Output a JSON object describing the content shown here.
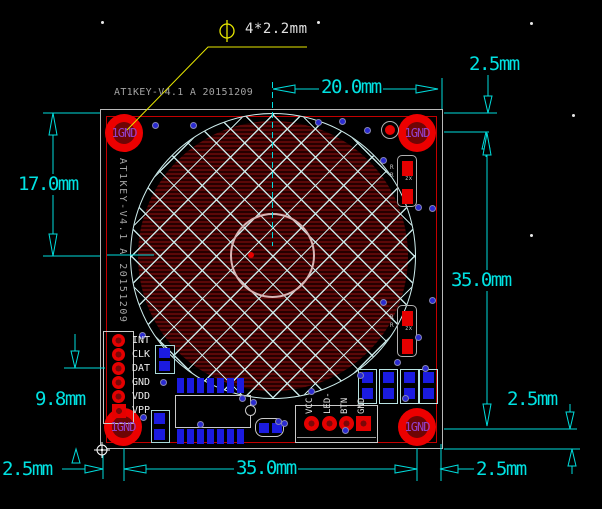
{
  "drawing": {
    "type": "pcb-dimension-drawing",
    "background": "#000000"
  },
  "silkscreen": {
    "title_top": "AT1KEY-V4.1 A 20151209",
    "title_side": "AT1KEY-V4.1 A 20151209"
  },
  "callout": {
    "text": "4*2.2mm",
    "symbol": "diameter"
  },
  "mounting_hole": {
    "label": "1GND"
  },
  "dimensions": {
    "top_width": "20.0mm",
    "top_right_offset": "2.5mm",
    "left_center_height": "17.0mm",
    "right_height": "35.0mm",
    "right_bottom_offset": "2.5mm",
    "left_connector_height": "9.8mm",
    "bottom_left_offset": "2.5mm",
    "bottom_width": "35.0mm",
    "bottom_right_offset": "2.5mm"
  },
  "connectors": {
    "programming_header": {
      "pins": [
        "INT",
        "CLK",
        "DAT",
        "GND",
        "VDD",
        "VPP"
      ]
    },
    "io_header": {
      "pins": [
        "VCC",
        "LED-",
        "BTN",
        "GND"
      ]
    }
  },
  "components": {
    "resistor_mark": "R",
    "resistor_code": "zx"
  },
  "colors": {
    "dimension": "#00e2e2",
    "leader": "#e8e800",
    "board_outline_red": "#c40000",
    "board_outline_gray": "#b9b9b9",
    "pad_blue": "#1b1be0",
    "pad_red": "#e60000",
    "hole_label_purple": "#9340c9",
    "silkscreen_gray": "#a2a2a2",
    "hatch": "#cfeeee",
    "copper_fill": "#5c0808"
  }
}
